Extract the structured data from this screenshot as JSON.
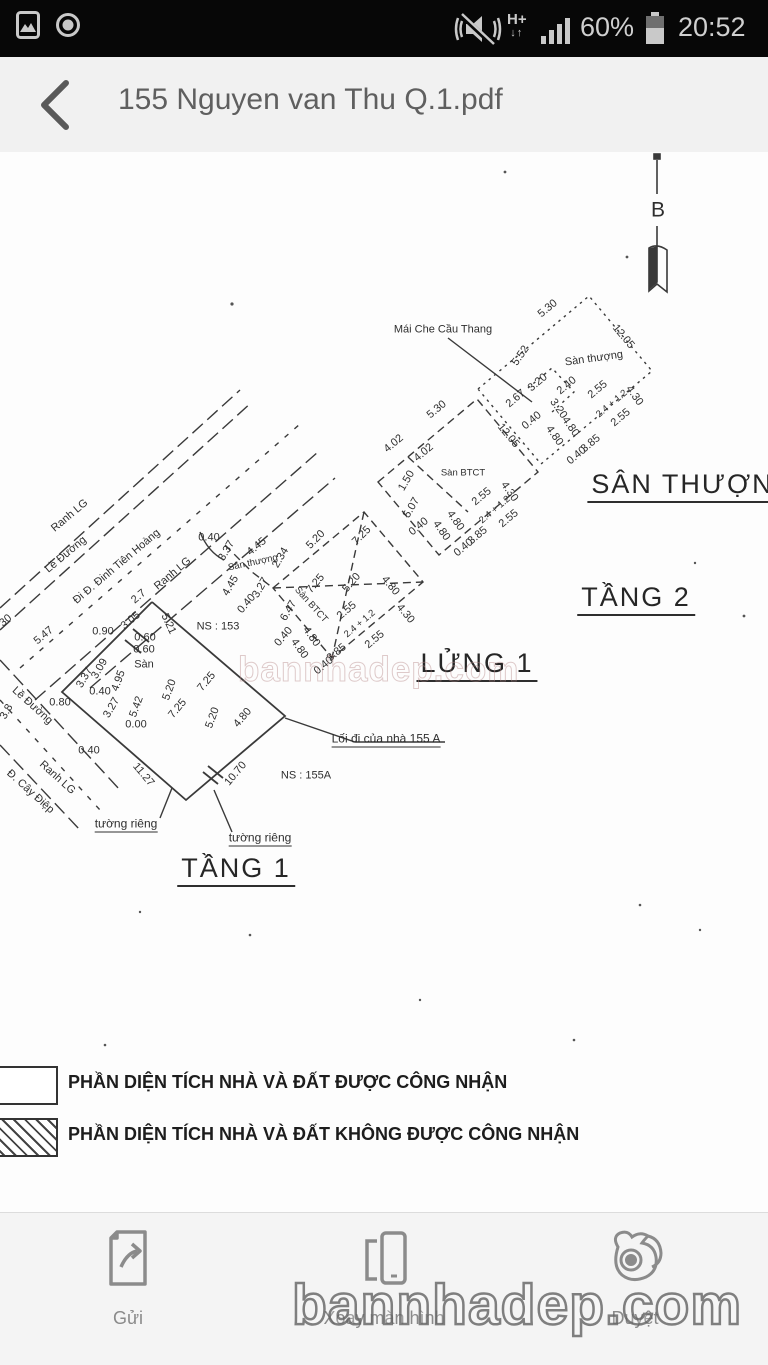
{
  "status_bar": {
    "time": "20:52",
    "battery_percent": "60%",
    "network_type": "H+",
    "left_icons": [
      "screenshot-image-icon",
      "smart-stay-ring-icon"
    ],
    "right_icons": [
      "vibrate-muted-icon",
      "hplus-data-icon",
      "signal-bars-icon",
      "battery-icon"
    ]
  },
  "header": {
    "title": "155 Nguyen van Thu Q.1.pdf",
    "back_icon": "chevron-left"
  },
  "drawing": {
    "floor_titles": [
      "SÂN THƯỢNG",
      "TẦNG 2",
      "LỬNG 1",
      "TẦNG 1"
    ],
    "section_marker": "B",
    "annotations": [
      {
        "t": "B",
        "x": 658,
        "y": 210,
        "r": 0,
        "c": "b"
      },
      {
        "t": "Mái Che Cầu Thang",
        "x": 443,
        "y": 330,
        "r": 0
      },
      {
        "t": "Sàn thượng",
        "x": 594,
        "y": 359,
        "r": -8
      },
      {
        "t": "5.30",
        "x": 548,
        "y": 309,
        "r": -40
      },
      {
        "t": "12.05",
        "x": 623,
        "y": 337,
        "r": 50
      },
      {
        "t": "5.52",
        "x": 521,
        "y": 356,
        "r": -55
      },
      {
        "t": "3.20",
        "x": 538,
        "y": 383,
        "r": -40
      },
      {
        "t": "2.40",
        "x": 567,
        "y": 386,
        "r": -40
      },
      {
        "t": "2.67",
        "x": 516,
        "y": 399,
        "r": -40
      },
      {
        "t": "0.40",
        "x": 532,
        "y": 421,
        "r": -40
      },
      {
        "t": "3.20",
        "x": 558,
        "y": 409,
        "r": 55
      },
      {
        "t": "4.80",
        "x": 570,
        "y": 427,
        "r": 55
      },
      {
        "t": "4.80",
        "x": 554,
        "y": 436,
        "r": 55
      },
      {
        "t": "2.55",
        "x": 598,
        "y": 390,
        "r": -40
      },
      {
        "t": "2.4 + 1.2",
        "x": 612,
        "y": 404,
        "r": -40,
        "c": "sm"
      },
      {
        "t": "2.55",
        "x": 621,
        "y": 418,
        "r": -40
      },
      {
        "t": "4.30",
        "x": 634,
        "y": 396,
        "r": 55
      },
      {
        "t": "3.85",
        "x": 591,
        "y": 444,
        "r": -40
      },
      {
        "t": "0.40",
        "x": 577,
        "y": 456,
        "r": -40
      },
      {
        "t": "5.30",
        "x": 437,
        "y": 410,
        "r": -40
      },
      {
        "t": "12.05",
        "x": 508,
        "y": 436,
        "r": 50
      },
      {
        "t": "4.02",
        "x": 394,
        "y": 444,
        "r": -40
      },
      {
        "t": "4.02",
        "x": 424,
        "y": 453,
        "r": -40
      },
      {
        "t": "1.50",
        "x": 407,
        "y": 481,
        "r": -60
      },
      {
        "t": "Sàn BTCT",
        "x": 463,
        "y": 473,
        "r": 0,
        "c": "sm"
      },
      {
        "t": "5.07",
        "x": 412,
        "y": 508,
        "r": -60
      },
      {
        "t": "0.40",
        "x": 419,
        "y": 527,
        "r": -40
      },
      {
        "t": "2.55",
        "x": 482,
        "y": 497,
        "r": -40
      },
      {
        "t": "2.4 + 1.2",
        "x": 495,
        "y": 510,
        "r": -40,
        "c": "sm"
      },
      {
        "t": "2.55",
        "x": 509,
        "y": 519,
        "r": -40
      },
      {
        "t": "4.30",
        "x": 509,
        "y": 492,
        "r": 55
      },
      {
        "t": "4.80",
        "x": 455,
        "y": 521,
        "r": 55
      },
      {
        "t": "4.80",
        "x": 441,
        "y": 531,
        "r": 55
      },
      {
        "t": "3.85",
        "x": 478,
        "y": 536,
        "r": -40
      },
      {
        "t": "0.40",
        "x": 464,
        "y": 548,
        "r": -40
      },
      {
        "t": "0.40",
        "x": 209,
        "y": 538,
        "r": 0
      },
      {
        "t": "3.37",
        "x": 227,
        "y": 551,
        "r": -60
      },
      {
        "t": "4.45",
        "x": 257,
        "y": 547,
        "r": -40
      },
      {
        "t": "Sàn thượng",
        "x": 253,
        "y": 563,
        "r": -12,
        "c": "sm"
      },
      {
        "t": "2.34",
        "x": 281,
        "y": 558,
        "r": -60
      },
      {
        "t": "5.20",
        "x": 316,
        "y": 540,
        "r": -45
      },
      {
        "t": "7.25",
        "x": 362,
        "y": 536,
        "r": -45
      },
      {
        "t": "4.45",
        "x": 231,
        "y": 586,
        "r": -60
      },
      {
        "t": "3.27",
        "x": 261,
        "y": 588,
        "r": -60
      },
      {
        "t": "0.40",
        "x": 247,
        "y": 604,
        "r": -50
      },
      {
        "t": "6.47",
        "x": 289,
        "y": 611,
        "r": -60
      },
      {
        "t": "Sàn BTCT",
        "x": 311,
        "y": 605,
        "r": 48,
        "c": "sm"
      },
      {
        "t": "7.25",
        "x": 316,
        "y": 584,
        "r": -50
      },
      {
        "t": "5.20",
        "x": 352,
        "y": 583,
        "r": -50
      },
      {
        "t": "4.80",
        "x": 390,
        "y": 586,
        "r": 50
      },
      {
        "t": "4.30",
        "x": 405,
        "y": 614,
        "r": 50
      },
      {
        "t": "2.55",
        "x": 347,
        "y": 611,
        "r": -40
      },
      {
        "t": "2.4 + 1.2",
        "x": 360,
        "y": 624,
        "r": -40,
        "c": "sm"
      },
      {
        "t": "2.55",
        "x": 375,
        "y": 640,
        "r": -40
      },
      {
        "t": "3.85",
        "x": 337,
        "y": 653,
        "r": -40
      },
      {
        "t": "0.40",
        "x": 324,
        "y": 666,
        "r": -40
      },
      {
        "t": "4.80",
        "x": 311,
        "y": 637,
        "r": 55
      },
      {
        "t": "4.80",
        "x": 299,
        "y": 649,
        "r": 55
      },
      {
        "t": "0.40",
        "x": 284,
        "y": 637,
        "r": -50
      },
      {
        "t": "Ranh LG",
        "x": 70,
        "y": 516,
        "r": -40
      },
      {
        "t": "Lề Đường",
        "x": 66,
        "y": 555,
        "r": -40
      },
      {
        "t": "Đi Đ. Đinh Tiên Hoàng",
        "x": 117,
        "y": 567,
        "r": -40
      },
      {
        "t": "Ranh LG",
        "x": 173,
        "y": 574,
        "r": -40
      },
      {
        "t": "NS : 153",
        "x": 218,
        "y": 627,
        "r": 0
      },
      {
        "t": "30",
        "x": 6,
        "y": 621,
        "r": -40
      },
      {
        "t": "5.47",
        "x": 44,
        "y": 636,
        "r": -40
      },
      {
        "t": "2.7",
        "x": 139,
        "y": 597,
        "r": -40
      },
      {
        "t": "3.05",
        "x": 131,
        "y": 621,
        "r": -40
      },
      {
        "t": "0.90",
        "x": 103,
        "y": 632,
        "r": 0
      },
      {
        "t": "5.21",
        "x": 168,
        "y": 624,
        "r": 65
      },
      {
        "t": "0.60",
        "x": 145,
        "y": 638,
        "r": 0
      },
      {
        "t": "0.60",
        "x": 144,
        "y": 650,
        "r": 0
      },
      {
        "t": "3.37",
        "x": 85,
        "y": 678,
        "r": -60
      },
      {
        "t": "3.09",
        "x": 100,
        "y": 669,
        "r": -60
      },
      {
        "t": "Sàn",
        "x": 144,
        "y": 665,
        "r": 0
      },
      {
        "t": "4.95",
        "x": 119,
        "y": 681,
        "r": -70
      },
      {
        "t": "0.40",
        "x": 100,
        "y": 692,
        "r": 0
      },
      {
        "t": "0.80",
        "x": 60,
        "y": 703,
        "r": 0
      },
      {
        "t": "3.27",
        "x": 112,
        "y": 708,
        "r": -60
      },
      {
        "t": "5.42",
        "x": 137,
        "y": 707,
        "r": -70
      },
      {
        "t": "5.20",
        "x": 170,
        "y": 690,
        "r": -70
      },
      {
        "t": "7.25",
        "x": 178,
        "y": 709,
        "r": -50
      },
      {
        "t": "7.25",
        "x": 207,
        "y": 682,
        "r": -50
      },
      {
        "t": "5.20",
        "x": 213,
        "y": 718,
        "r": -70
      },
      {
        "t": "4.80",
        "x": 243,
        "y": 718,
        "r": -50
      },
      {
        "t": "3.8",
        "x": 7,
        "y": 712,
        "r": -60
      },
      {
        "t": "0.00",
        "x": 136,
        "y": 725,
        "r": 0
      },
      {
        "t": "0.40",
        "x": 89,
        "y": 751,
        "r": 0
      },
      {
        "t": "Lề Đường",
        "x": 32,
        "y": 706,
        "r": 42
      },
      {
        "t": "11.27",
        "x": 143,
        "y": 775,
        "r": 50
      },
      {
        "t": "10.70",
        "x": 236,
        "y": 774,
        "r": -50
      },
      {
        "t": "Ranh LG",
        "x": 57,
        "y": 778,
        "r": 42
      },
      {
        "t": "Đ. Cây Điệp",
        "x": 30,
        "y": 792,
        "r": 42
      },
      {
        "t": "NS : 155A",
        "x": 306,
        "y": 776,
        "r": 0
      },
      {
        "t": "Lối đi của nhà 155 A",
        "x": 386,
        "y": 740,
        "r": 0,
        "c": "ul"
      },
      {
        "t": "tường riêng",
        "x": 126,
        "y": 825,
        "r": 0,
        "c": "ul"
      },
      {
        "t": "tường riêng",
        "x": 260,
        "y": 839,
        "r": 0,
        "c": "ul"
      },
      {
        "t": "SÂN THƯỢNG",
        "x": 694,
        "y": 487,
        "r": 0,
        "c": "title"
      },
      {
        "t": "TẦNG 2",
        "x": 636,
        "y": 600,
        "r": 0,
        "c": "title"
      },
      {
        "t": "LỬNG 1",
        "x": 477,
        "y": 666,
        "r": 0,
        "c": "title"
      },
      {
        "t": "TẦNG 1",
        "x": 236,
        "y": 871,
        "r": 0,
        "c": "title"
      }
    ]
  },
  "legend": {
    "items": [
      {
        "label": "PHẦN DIỆN TÍCH NHÀ VÀ ĐẤT ĐƯỢC CÔNG NHẬN",
        "swatch": "plain"
      },
      {
        "label": "PHẦN DIỆN TÍCH NHÀ VÀ ĐẤT KHÔNG ĐƯỢC CÔNG NHẬN",
        "swatch": "hatched"
      }
    ]
  },
  "watermark": {
    "text": "bannhadep.com"
  },
  "toolbar": {
    "items": [
      {
        "label": "Gửi",
        "icon": "share-document-icon"
      },
      {
        "label": "Xoay màn hình",
        "icon": "rotate-screen-icon"
      },
      {
        "label": "Duyệt",
        "icon": "uc-browser-icon"
      }
    ]
  },
  "colors": {
    "statusbar_bg": "#070707",
    "header_bg": "#f1f1f1",
    "toolbar_bg": "#f4f4f4",
    "line": "#3a3a3a"
  }
}
